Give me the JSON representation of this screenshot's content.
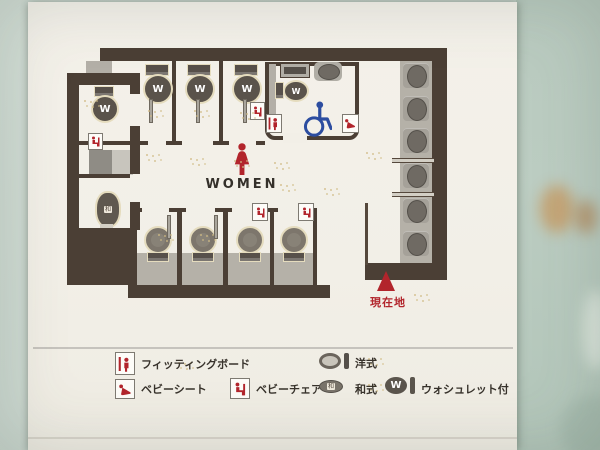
{
  "board": {
    "map": {
      "women_label": "WOMEN",
      "current_location_label": "現在地",
      "washlet_letter": "W",
      "japanese_style_letter": "和"
    },
    "legend": {
      "items": [
        {
          "id": "fitting-board",
          "label": "フィッティングボード"
        },
        {
          "id": "baby-seat",
          "label": "ベビーシート"
        },
        {
          "id": "baby-chair",
          "label": "ベビーチェア"
        },
        {
          "id": "western-style",
          "label": "洋式"
        },
        {
          "id": "japanese-style",
          "label": "和式"
        },
        {
          "id": "washlet",
          "label": "ウォシュレット付"
        }
      ],
      "washlet_letter": "W",
      "japanese_style_letter": "和"
    },
    "colors": {
      "wall": "#4b3f35",
      "accent_red": "#b2252c",
      "accent_blue": "#2c4da0"
    }
  }
}
